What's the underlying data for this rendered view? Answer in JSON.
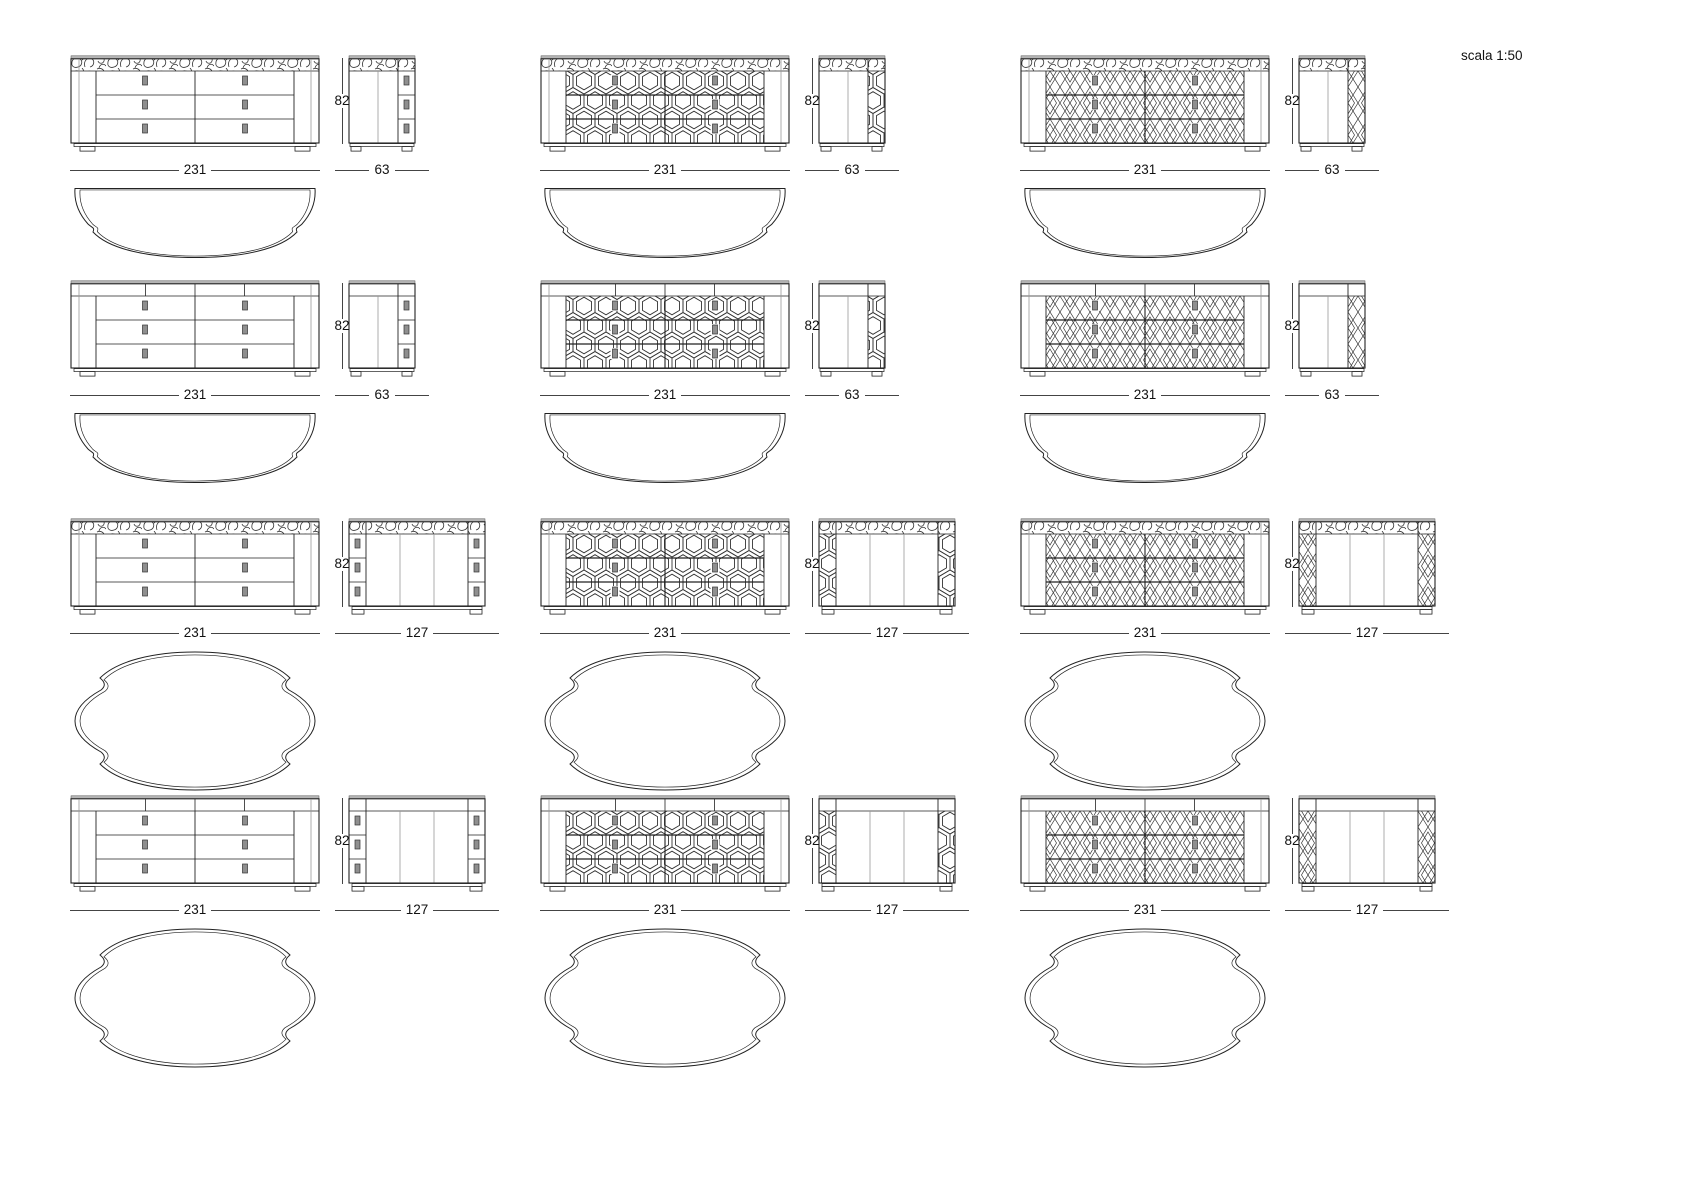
{
  "scale_label": "scala 1:50",
  "dims": {
    "front_width": "231",
    "height": "82",
    "depth_narrow": "63",
    "depth_wide": "127"
  },
  "grid": {
    "columns": [
      {
        "name": "plain-drawer-front",
        "front_style": "drawers"
      },
      {
        "name": "hexagon-lattice-front",
        "front_style": "hex"
      },
      {
        "name": "diamond-lattice-front",
        "front_style": "diamond"
      }
    ],
    "rows": [
      {
        "name": "decorated-top-shallow",
        "top_band": "decorated",
        "depth_label": "63",
        "plan": "half-oval"
      },
      {
        "name": "plain-top-shallow",
        "top_band": "plain",
        "depth_label": "63",
        "plan": "half-oval"
      },
      {
        "name": "decorated-top-deep",
        "top_band": "decorated",
        "depth_label": "127",
        "plan": "oval"
      },
      {
        "name": "plain-top-deep",
        "top_band": "plain",
        "depth_label": "127",
        "plan": "oval"
      }
    ]
  }
}
